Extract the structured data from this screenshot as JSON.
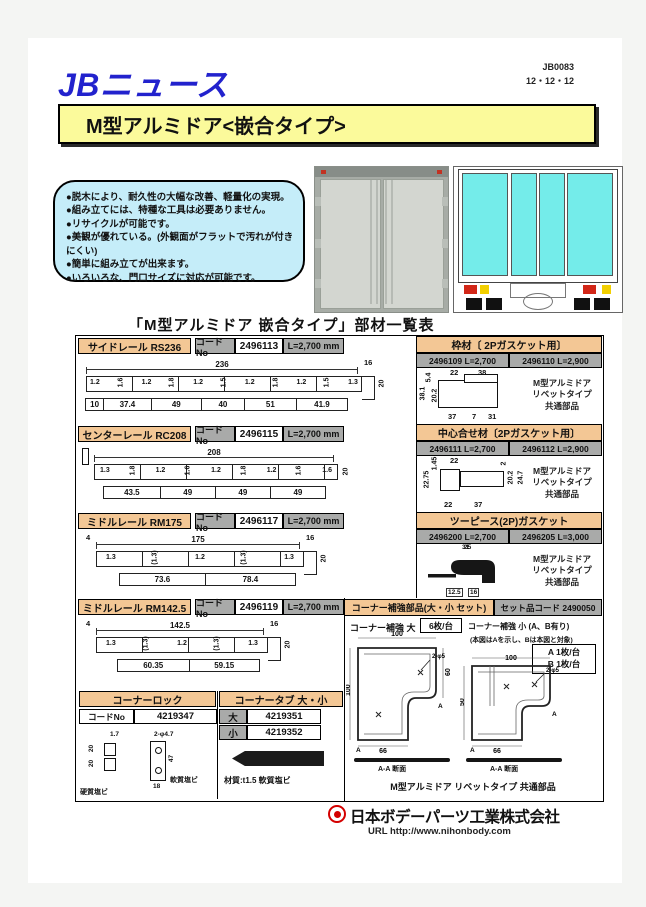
{
  "header": {
    "code": "JB0083",
    "date": "12・12・12",
    "brand": "JBニュース",
    "banner": "M型アルミドア<嵌合タイプ>"
  },
  "features": [
    "●脱木により、耐久性の大幅な改善、軽量化の実現。",
    "●組み立てには、特種な工具は必要ありません。",
    "●リサイクルが可能です。",
    "●美観が優れている。(外観面がフラットで汚れが付きにくい)",
    "●簡単に組み立てが出来ます。",
    "●いろいろな、門口サイズに対応が可能です。"
  ],
  "list_title": "「M型アルミドア 嵌合タイプ」部材一覧表",
  "labels": {
    "code_no": "コードNo"
  },
  "rails": [
    {
      "name": "サイドレール RS236",
      "code": "2496113",
      "length": "L=2,700 mm",
      "height": "20",
      "top_dims": {
        "width": "236",
        "right": "16"
      },
      "thickness": [
        "1.2",
        "1.6",
        "1.2",
        "1.8",
        "1.2",
        "1.5",
        "1.2",
        "1.8",
        "1.2",
        "1.5",
        "1.3"
      ],
      "bottoms": [
        "10",
        "37.4",
        "49",
        "40",
        "51",
        "41.9"
      ]
    },
    {
      "name": "センターレール RC208",
      "code": "2496115",
      "length": "L=2,700 mm",
      "height": "20",
      "top_dims": {
        "width": "208"
      },
      "thickness": [
        "1.3",
        "1.8",
        "1.2",
        "1.6",
        "1.2",
        "1.8",
        "1.2",
        "1.6",
        "1.6"
      ],
      "bottoms": [
        "43.5",
        "49",
        "49",
        "49"
      ]
    },
    {
      "name": "ミドルレール RM175",
      "code": "2496117",
      "length": "L=2,700 mm",
      "height": "20",
      "top_dims": {
        "left": "4",
        "width": "175",
        "right": "16"
      },
      "thickness": [
        "1.3",
        "(1.3)",
        "1.2",
        "(1.3)",
        "1.3"
      ],
      "bottoms": [
        "73.6",
        "78.4"
      ]
    },
    {
      "name": "ミドルレール RM142.5",
      "code": "2496119",
      "length": "L=2,700 mm",
      "height": "20",
      "top_dims": {
        "left": "4",
        "width": "142.5",
        "right": "16"
      },
      "thickness": [
        "1.3",
        "(1.3)",
        "1.2",
        "(1.3)",
        "1.3"
      ],
      "bottoms": [
        "60.35",
        "59.15"
      ]
    }
  ],
  "corner_lock": {
    "title": "コーナーロック",
    "code": "4219347",
    "dims": [
      "1.7",
      "2-φ4.7",
      "20",
      "20",
      "47",
      "18"
    ],
    "mat_left": "硬質塩ビ",
    "mat_right": "軟質塩ビ"
  },
  "corner_tab": {
    "title": "コーナータブ 大・小",
    "large": "大",
    "large_code": "4219351",
    "small": "小",
    "small_code": "4219352",
    "material": "材質:t1.5 軟質塩ビ"
  },
  "frame": {
    "title": "枠材〔 2Pガスケット用〕",
    "code1": "2496109  L=2,700",
    "code2": "2496110  L=2,900",
    "dims": [
      "5.4",
      "22",
      "38",
      "38.1",
      "20.2",
      "37",
      "7",
      "31"
    ]
  },
  "center_joint": {
    "title": "中心合せ材〔2Pガスケット用〕",
    "code1": "2496111  L=2,700",
    "code2": "2496112  L=2,900",
    "dims": [
      "1.45",
      "22",
      "2",
      "22.75",
      "20.2",
      "24.7",
      "22",
      "37"
    ]
  },
  "gasket": {
    "title": "ツーピース(2P)ガスケット",
    "code1": "2496200  L=2,700",
    "code2": "2496205  L=3,000",
    "dims": [
      "31",
      "25",
      "12.5",
      "16"
    ]
  },
  "common_note": [
    "M型アルミドア",
    "リベットタイプ",
    "共通部品"
  ],
  "corner_set": {
    "title": "コーナー補強部品(大・小 セット)",
    "set_code": "セット品コード 2490050",
    "large_label": "コーナー補強 大",
    "large_qty": "6枚/台",
    "small_label": "コーナー補強 小 (A、B有り)",
    "small_note": "(本図はAを示し、Bは本図と対象)",
    "qty_a": "A 1枚/台",
    "qty_b": "B 1枚/台",
    "large_dims": {
      "top": "100",
      "left": "100",
      "bottom": "66",
      "right": "60",
      "holes": "2-φ5"
    },
    "small_dims": {
      "top": "100",
      "left": "50",
      "bottom": "66",
      "holes": "2-φ5"
    },
    "section": "A-A 断面",
    "marker": "A",
    "note": "M型アルミドア リベットタイプ 共通部品"
  },
  "footer": {
    "company": "日本ボデーパーツ工業株式会社",
    "url": "URL http://www.nihonbody.com"
  }
}
